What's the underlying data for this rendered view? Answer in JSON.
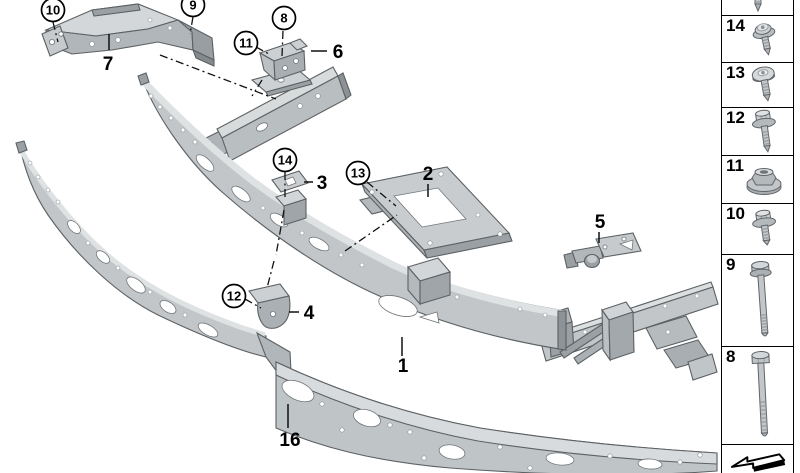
{
  "colors": {
    "background": "#ffffff",
    "line": "#000000",
    "part_fill": "#c6cacc",
    "part_shade": "#a7adb0",
    "part_highlight": "#dfe2e3"
  },
  "diagram": {
    "part_labels": [
      {
        "text": "7"
      },
      {
        "text": "6"
      },
      {
        "text": "3"
      },
      {
        "text": "2"
      },
      {
        "text": "4"
      },
      {
        "text": "5"
      },
      {
        "text": "1"
      },
      {
        "text": "16"
      }
    ],
    "callouts": [
      {
        "text": "10"
      },
      {
        "text": "9"
      },
      {
        "text": "8"
      },
      {
        "text": "11"
      },
      {
        "text": "14"
      },
      {
        "text": "13"
      },
      {
        "text": "12"
      }
    ]
  },
  "sidebar": {
    "items": [
      {
        "num": "",
        "icon": "screw-tip-icon"
      },
      {
        "num": "14",
        "icon": "washer-head-screw-icon"
      },
      {
        "num": "13",
        "icon": "button-head-screw-icon"
      },
      {
        "num": "12",
        "icon": "hex-washer-screw-icon"
      },
      {
        "num": "11",
        "icon": "flange-nut-icon"
      },
      {
        "num": "10",
        "icon": "hex-flange-screw-icon"
      },
      {
        "num": "9",
        "icon": "long-hex-bolt-icon"
      },
      {
        "num": "8",
        "icon": "long-hex-bolt-icon"
      },
      {
        "num": "",
        "icon": "direction-arrow-icon"
      }
    ]
  }
}
